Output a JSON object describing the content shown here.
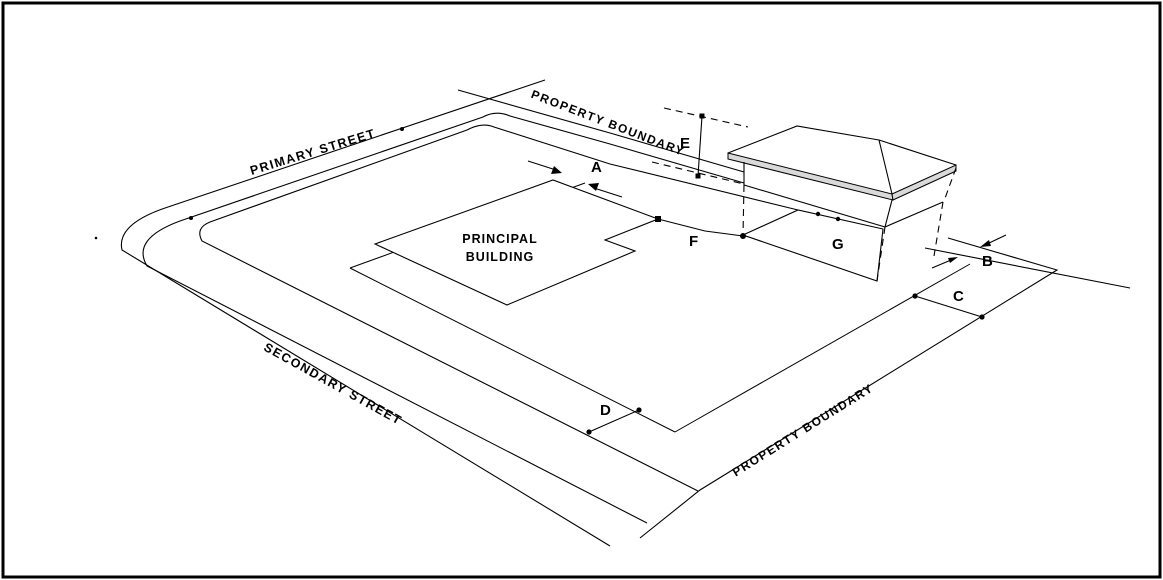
{
  "labels": {
    "primary_street": "PRIMARY STREET",
    "secondary_street": "SECONDARY STREET",
    "property_boundary_top": "PROPERTY BOUNDARY",
    "property_boundary_bottom": "PROPERTY BOUNDARY",
    "principal_building_line1": "PRINCIPAL",
    "principal_building_line2": "BUILDING"
  },
  "markers": {
    "a": "A",
    "b": "B",
    "c": "C",
    "d": "D",
    "e": "E",
    "f": "F",
    "g": "G"
  },
  "colors": {
    "line": "#000000",
    "fascia_fill": "#d9d9d9",
    "background": "#ffffff"
  }
}
